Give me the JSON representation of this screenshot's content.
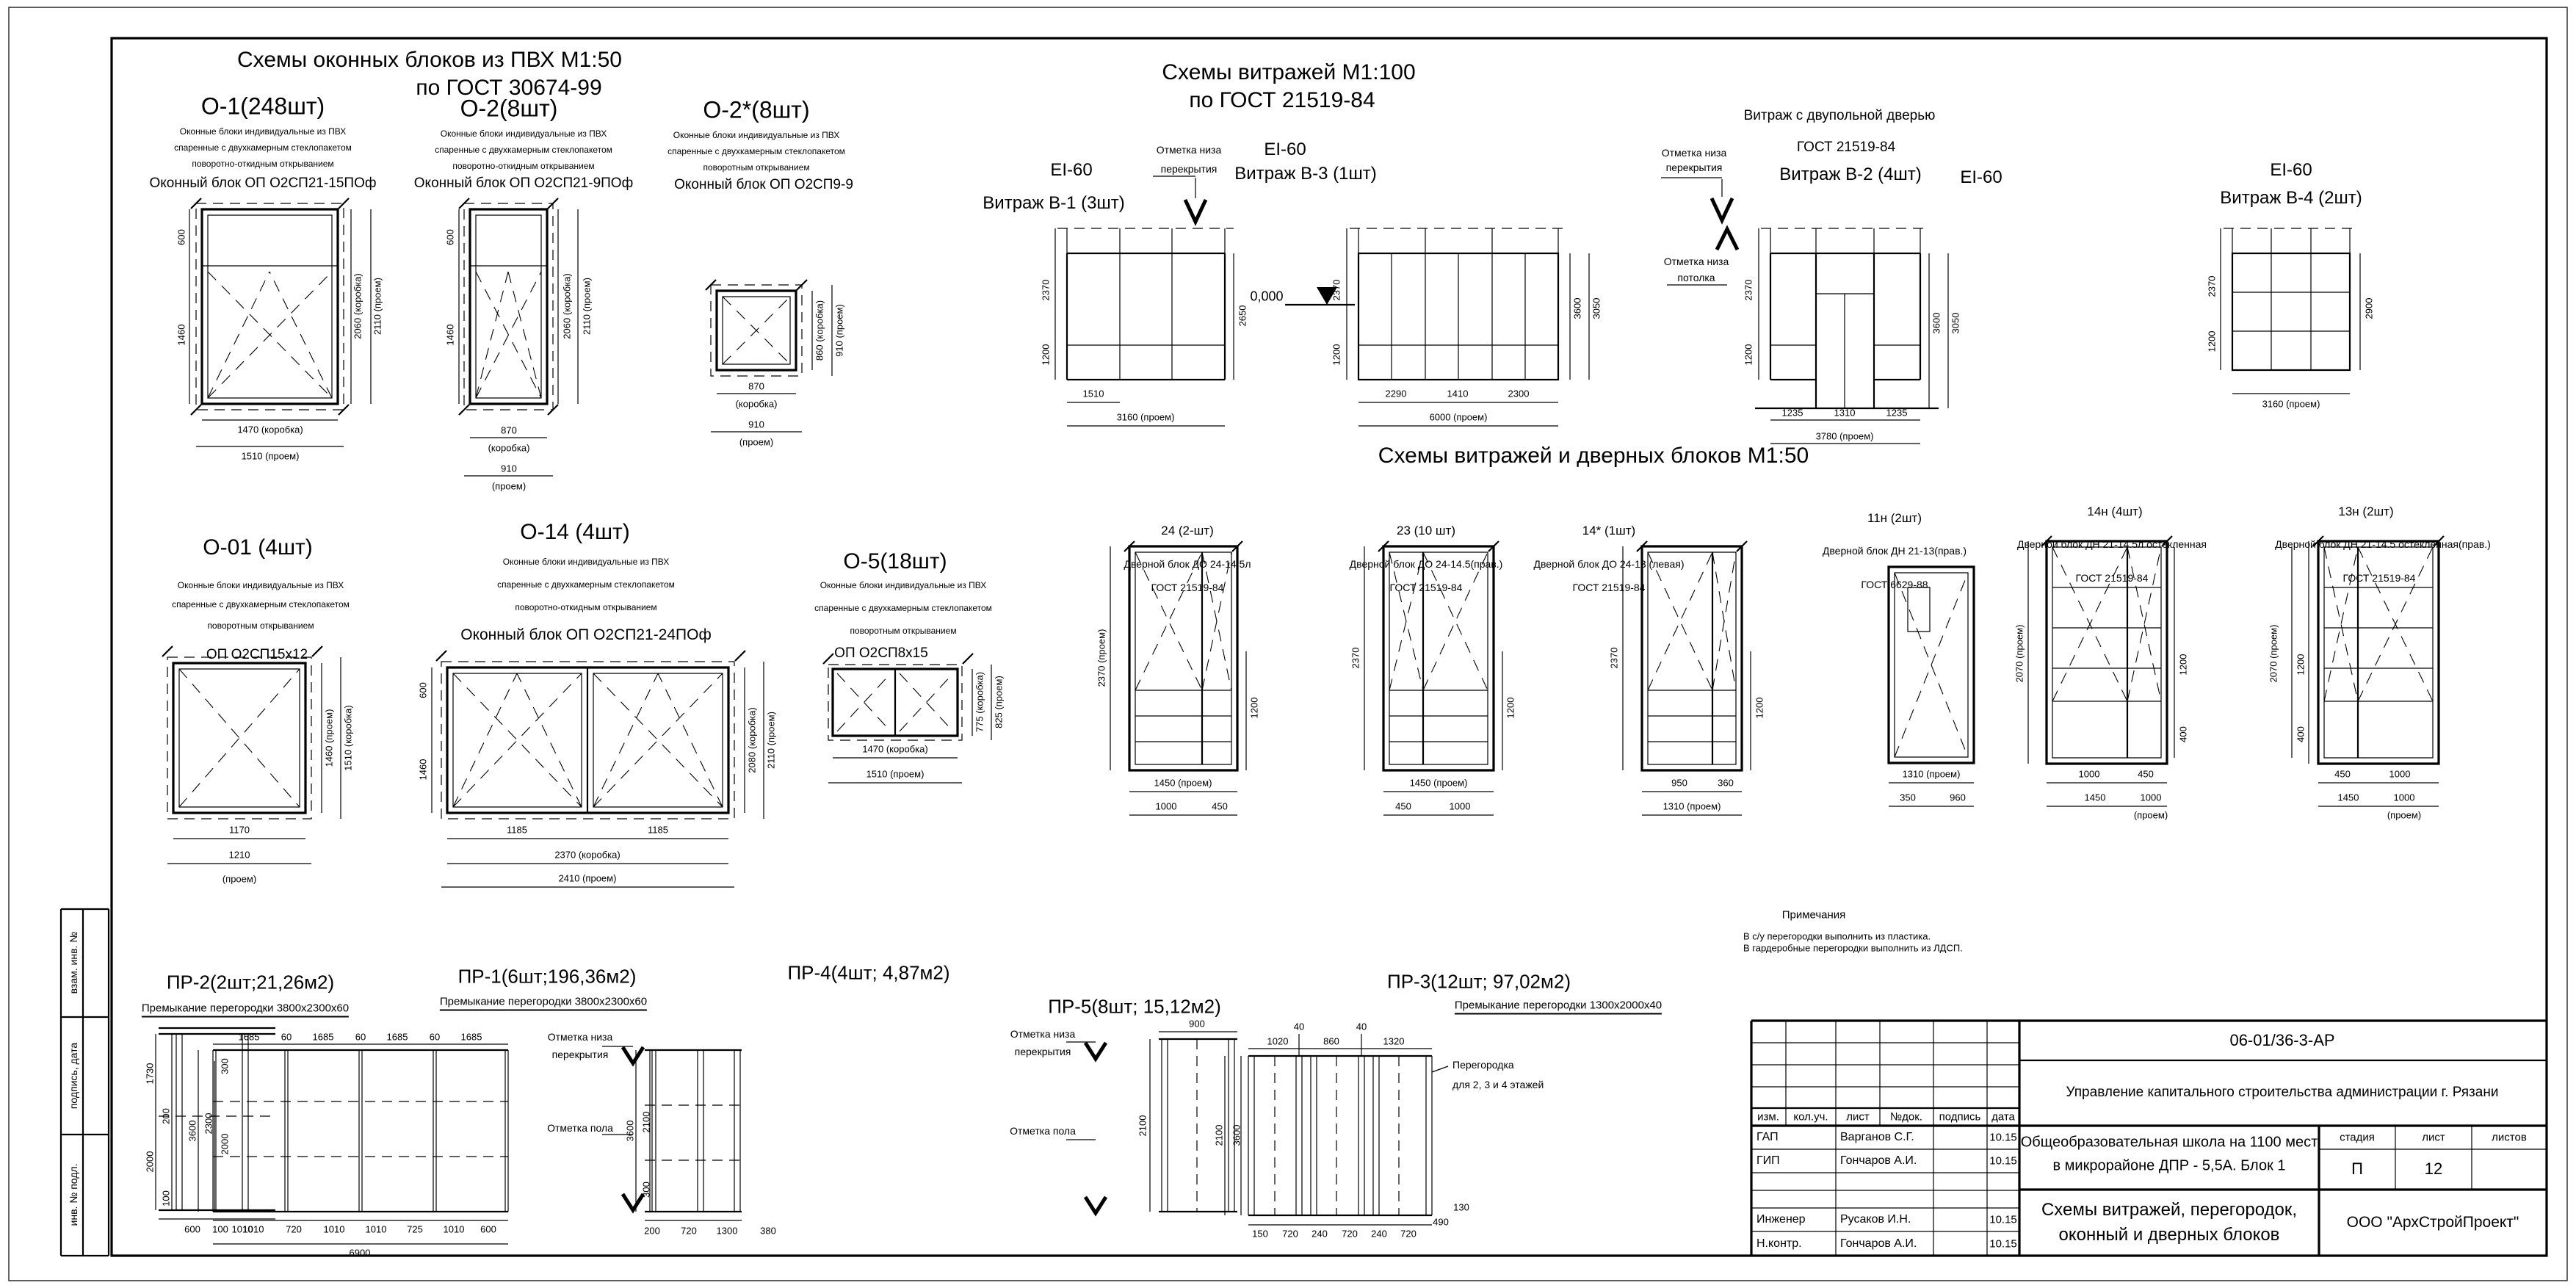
{
  "section_titles": {
    "windows1": "Схемы оконных блоков из ПВХ М1:50",
    "windows2": "по ГОСТ 30674-99",
    "vitrages1": "Схемы витражей М1:100",
    "vitrages2": "по ГОСТ 21519-84",
    "middle": "Схемы витражей и дверных блоков М1:50"
  },
  "windows": {
    "o1": {
      "title": "О-1(248шт)",
      "desc": [
        "Оконные блоки индивидуальные из ПВХ",
        "спаренные с двухкамерным стеклопакетом",
        "поворотно-откидным открыванием"
      ],
      "block": "Оконный блок ОП О2СП21-15ПОф",
      "dim_left": [
        "600",
        "1460"
      ],
      "dim_right": [
        "2060 (коробка)",
        "2110 (проем)"
      ],
      "dim_bottom": [
        "1470 (коробка)",
        "1510 (проем)"
      ]
    },
    "o2": {
      "title": "О-2(8шт)",
      "desc": [
        "Оконные блоки индивидуальные из ПВХ",
        "спаренные с двухкамерным стеклопакетом",
        "поворотно-откидным открыванием"
      ],
      "block": "Оконный блок ОП О2СП21-9ПОф",
      "dim_left": [
        "600",
        "1460"
      ],
      "dim_right": [
        "2060 (коробка)",
        "2110 (проем)"
      ],
      "dim_bottom": [
        "870",
        "(коробка)",
        "910",
        "(проем)"
      ]
    },
    "o2s": {
      "title": "О-2*(8шт)",
      "desc": [
        "Оконные блоки индивидуальные из ПВХ",
        "спаренные с двухкамерным стеклопакетом",
        "поворотным открыванием"
      ],
      "block": "Оконный блок ОП О2СП9-9",
      "dim_right": [
        "860 (коробка)",
        "910 (проем)"
      ],
      "dim_bottom": [
        "870",
        "(коробка)",
        "910",
        "(проем)"
      ]
    },
    "o01": {
      "title": "О-01 (4шт)",
      "desc": [
        "Оконные блоки индивидуальные из ПВХ",
        "спаренные с двухкамерным стеклопакетом",
        "поворотным открыванием"
      ],
      "block": "ОП О2СП15х12",
      "dim_right": [
        "1460 (проем)",
        "1510 (коробка)"
      ],
      "dim_bottom": [
        "1170",
        "1210",
        "(проем)"
      ]
    },
    "o14": {
      "title": "О-14 (4шт)",
      "desc": [
        "Оконные блоки индивидуальные из ПВХ",
        "спаренные с двухкамерным стеклопакетом",
        "поворотно-откидным открыванием"
      ],
      "block": "Оконный блок ОП О2СП21-24ПОф",
      "dim_left": [
        "600",
        "1460"
      ],
      "dim_right": [
        "2080 (коробка)",
        "2110 (проем)"
      ],
      "dim_bottom": [
        "1185",
        "1185",
        "2370 (коробка)",
        "2410 (проем)"
      ]
    },
    "o5": {
      "title": "О-5(18шт)",
      "desc": [
        "Оконные блоки индивидуальные из ПВХ",
        "спаренные с двухкамерным стеклопакетом",
        "поворотным открыванием"
      ],
      "block": "ОП О2СП8х15",
      "dim_right": [
        "775 (коробка)",
        "825 (проем)"
      ],
      "dim_bottom": [
        "1470 (коробка)",
        "1510 (проем)"
      ]
    }
  },
  "vitrages": {
    "v1": {
      "ei": "EI-60",
      "title": "Витраж В-1 (3шт)",
      "dim_left": [
        "2370",
        "1200"
      ],
      "dim_right": [
        "2650"
      ],
      "dim_bottom": [
        "1510",
        "3160 (проем)"
      ]
    },
    "v3": {
      "ei": "EI-60",
      "title": "Витраж В-3 (1шт)",
      "dim_left": [
        "2370",
        "1200"
      ],
      "dim_right": [
        "3600",
        "3050"
      ],
      "dim_bottom": [
        "2290",
        "1410",
        "2300",
        "6000 (проем)"
      ]
    },
    "v2": {
      "note1": "Витраж с двупольной дверью",
      "note2": "ГОСТ 21519-84",
      "title": "Витраж В-2 (4шт)",
      "ei": "EI-60",
      "dim_left": [
        "2370",
        "1200"
      ],
      "dim_right": [
        "3600",
        "3050"
      ],
      "dim_bottom": [
        "1235",
        "1310",
        "1235",
        "3780 (проем)"
      ]
    },
    "v4": {
      "ei": "EI-60",
      "title": "Витраж В-4 (2шт)",
      "dim_left": [
        "2370",
        "1200"
      ],
      "dim_right": [
        "2900"
      ],
      "dim_bottom": [
        "3160 (проем)"
      ]
    },
    "level_zero": "0,000",
    "mark_slab": [
      "Отметка низа",
      "перекрытия"
    ],
    "mark_ceiling": [
      "Отметка низа",
      "потолка"
    ]
  },
  "doors": {
    "d24": {
      "num": "24 (2-шт)",
      "name": "Дверной блок ДО 24-14.5л",
      "gost": "ГОСТ 21519-84",
      "dim_left": "2370 (проем)",
      "dim_right": [
        "1200"
      ],
      "dim_bottom": [
        "1450 (проем)",
        "1000",
        "450"
      ]
    },
    "d23": {
      "num": "23 (10 шт)",
      "name": "Дверной блок ДО 24-14.5(прав.)",
      "gost": "ГОСТ 21519-84",
      "dim_left": "2370",
      "dim_right": [
        "1200"
      ],
      "dim_bottom": [
        "1450 (проем)",
        "450",
        "1000"
      ]
    },
    "d14s": {
      "num": "14* (1шт)",
      "name": "Дверной блок ДО 24-13 (левая)",
      "gost": "ГОСТ 21519-84",
      "dim_left": "2370",
      "dim_right": [
        "1200"
      ],
      "dim_bottom": [
        "950",
        "360",
        "1310 (проем)"
      ]
    },
    "d11n": {
      "num": "11н (2шт)",
      "name": "Дверной блок ДН 21-13(прав.)",
      "gost": "ГОСТ 6629-88",
      "dim_bottom": [
        "1310 (проем)",
        "350",
        "960"
      ]
    },
    "d14n": {
      "num": "14н (4шт)",
      "name": "Дверной блок ДН 21-14.5л остекленная",
      "gost": "ГОСТ 21519-84",
      "dim_left": "2070 (проем)",
      "dim_right": [
        "1200",
        "400"
      ],
      "dim_bottom": [
        "1000",
        "450",
        "1450",
        "1000",
        "(проем)"
      ]
    },
    "d13n": {
      "num": "13н (2шт)",
      "name": "Дверной блок ДН 21-14.5 остекленная(прав.)",
      "gost": "ГОСТ 21519-84",
      "dim_left": "2070 (проем)",
      "dim_right": [
        "1200",
        "400"
      ],
      "dim_bottom": [
        "450",
        "1000",
        "1450",
        "1000",
        "(проем)"
      ]
    }
  },
  "partitions": {
    "pr2": {
      "title": "ПР-2(2шт;21,26м2)",
      "sub": "Премыкание перегородки 3800х2300х60",
      "dim_left": [
        "1730",
        "200",
        "2000",
        "100"
      ],
      "dim_bottom": [
        "600",
        "1010"
      ]
    },
    "pr1": {
      "title": "ПР-1(6шт;196,36м2)",
      "sub": "Премыкание перегородки 3800х2300х60",
      "dim_top": [
        "1685",
        "60",
        "1685",
        "60",
        "1685",
        "60",
        "1685"
      ],
      "dim_left": [
        "3600",
        "2300",
        "2000",
        "300"
      ],
      "dim_bottom": [
        "100",
        "1010",
        "720",
        "1010",
        "1010",
        "725",
        "1010",
        "600"
      ],
      "total": "6900"
    },
    "pr4": {
      "title": "ПР-4(4шт; 4,87м2)",
      "dim_left": [
        "3600",
        "2100",
        "300"
      ],
      "dim_bottom": [
        "200",
        "720",
        "1300",
        "380"
      ]
    },
    "pr5": {
      "title": "ПР-5(8шт; 15,12м2)",
      "dim_top": "900",
      "dim_left": "2100"
    },
    "pr3": {
      "title": "ПР-3(12шт; 97,02м2)",
      "sub": "Премыкание перегородки 1300х2000х40",
      "dim_top": [
        "40",
        "40",
        "1020",
        "860",
        "1320"
      ],
      "note": [
        "Перегородка",
        "для 2, 3 и 4 этажей"
      ],
      "dim_left": [
        "3600",
        "2100"
      ],
      "dim_bottom": [
        "150",
        "720",
        "240",
        "720",
        "240",
        "720",
        "490",
        "130"
      ]
    },
    "mark_slab": [
      "Отметка низа",
      "перекрытия"
    ],
    "mark_floor": "Отметка пола"
  },
  "notes": {
    "title": "Примечания",
    "lines": [
      "В с/у перегородки выполнить из пластика.",
      "В гардеробные перегородки выполнить из ЛДСП."
    ]
  },
  "stamps": [
    "взам. инв. №",
    "подпись, дата",
    "инв. № подл."
  ],
  "titleblock": {
    "doc_code": "06-01/36-3-АР",
    "org": "Управление капитального строительства администрации г. Рязани",
    "object": [
      "Общеобразовательная школа на 1100 мест",
      "в микрорайоне ДПР - 5,5А. Блок 1"
    ],
    "sheet_name": [
      "Схемы витражей, перегородок,",
      "оконный и дверных блоков"
    ],
    "company": "ООО \"АрхСтройПроект\"",
    "header_cols": [
      "изм.",
      "кол.уч.",
      "лист",
      "№док.",
      "подпись",
      "дата"
    ],
    "stage_cols": [
      "стадия",
      "лист",
      "листов"
    ],
    "stage": "П",
    "sheet": "12",
    "staff": [
      {
        "role": "ГАП",
        "name": "Варганов С.Г.",
        "date": "10.15"
      },
      {
        "role": "ГИП",
        "name": "Гончаров А.И.",
        "date": "10.15"
      },
      {
        "role": "Инженер",
        "name": "Русаков И.Н.",
        "date": "10.15"
      },
      {
        "role": "Н.контр.",
        "name": "Гончаров А.И.",
        "date": "10.15"
      }
    ]
  }
}
